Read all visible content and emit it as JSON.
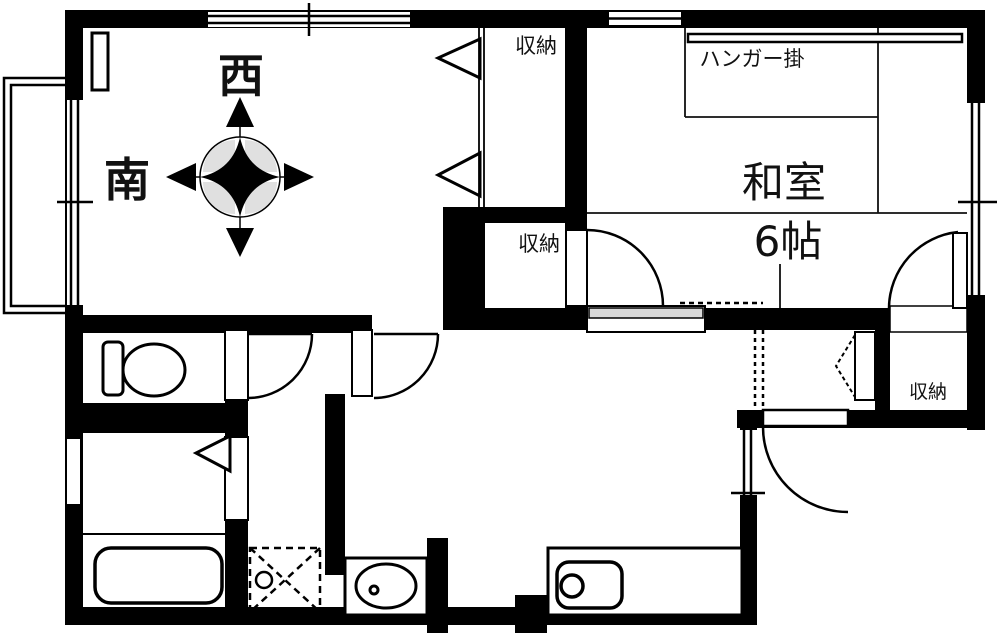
{
  "plan": {
    "title": "apartment-floor-plan",
    "compass": {
      "west_label": "西",
      "south_label": "南"
    },
    "rooms": {
      "washitsu": {
        "name": "和室",
        "area": "6帖",
        "hanger_label": "ハンガー掛"
      },
      "closet_top_label": "収納",
      "closet_mid_label": "収納",
      "closet_entrance_label": "収納"
    },
    "colors": {
      "wall": "#000000",
      "background": "#ffffff",
      "compass_petal": "#e0e0e0",
      "sliding_band": "#d9d9d9",
      "line": "#111111"
    }
  }
}
